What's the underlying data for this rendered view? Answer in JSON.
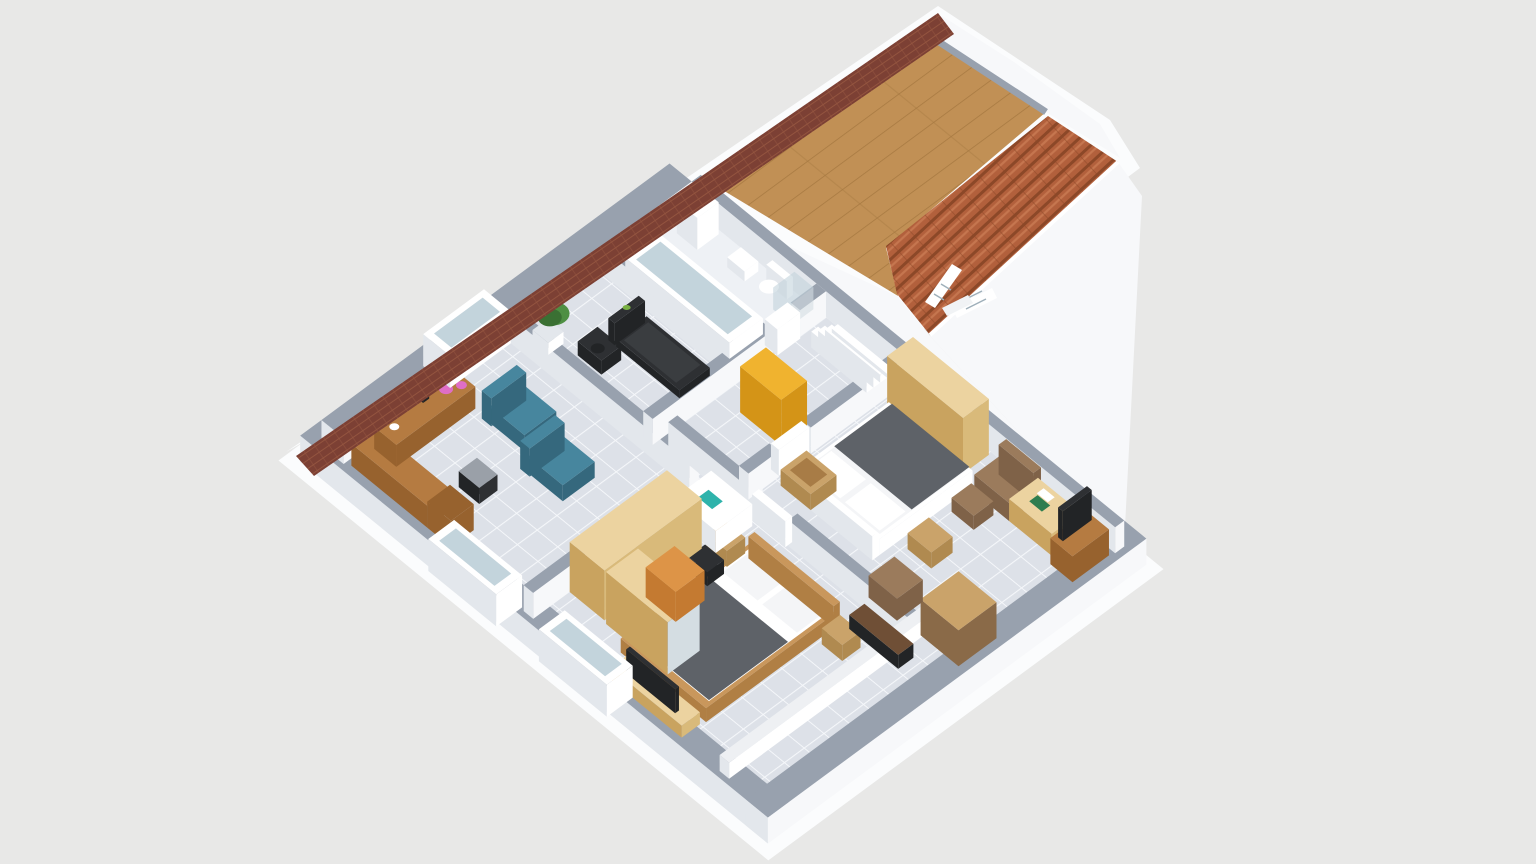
{
  "scene": {
    "type": "isometric-3d-floorplan-render",
    "view": "dollhouse cutaway of an attic storey, roof partially removed",
    "background": "plain light gray studio backdrop"
  },
  "colors": {
    "bg": "#e8e8e7",
    "slab": "#fbfcfd",
    "wallTop": "#98a1ae",
    "wallWhite": "#f7f8fa",
    "wallShade": "#e3e7ec",
    "floorBase": "#dde1e8",
    "floorLine": "#f5f7fa",
    "bathFloor": "#eef1f5",
    "corridorLow": "#eef0f3",
    "woodBase": "#c19055",
    "woodDark": "#a87a42",
    "roofTile": "#b2603c",
    "roofTileLight": "#c87a52",
    "roofTileDark": "#8c4828",
    "brickStrip": "#7c4034",
    "brickLine": "#93543f",
    "lightWood": "#ecd3a0",
    "lightWoodSide": "#d9ba7a",
    "lightWoodDark": "#c9a35f",
    "midWood": "#b57b41",
    "midWoodSide": "#97622e",
    "orange": "#dd9447",
    "orangeSide": "#c47a31",
    "yellow": "#f0b32f",
    "yellowSide": "#d49417",
    "teal": "#47869e",
    "tealSide": "#35687d",
    "blanket": "#5e6268",
    "pillow": "#f4f5f7",
    "white": "#ffffff",
    "bedFrame": "#c9975c",
    "bedFrameSide": "#b07f44",
    "brown": "#9b7b5c",
    "brownSide": "#7f6248",
    "benchBrown": "#6f4f36",
    "dark": "#2e3033",
    "darkSide": "#222426",
    "beltDark": "#3a3d40",
    "greenAccent": "#79b043",
    "green": "#4e8f43",
    "greenDark": "#3a7033",
    "pink": "#df6ec6",
    "metalGray": "#9aa0a8",
    "tan": "#caa36a",
    "tanSide": "#b08a50",
    "crateInner": "#a87c46",
    "shelfSide": "#8a6a48",
    "glass": "#c3d4dc",
    "mirror": "#d4dde2",
    "laptopTeal": "#2fb3ab",
    "bookGreen": "#2e7d4f",
    "paneLine": "#9fb0ba"
  },
  "rooms": [
    {
      "name": "Home office",
      "furniture": [
        "L-shaped wooden desk",
        "desk chair",
        "teal armchair",
        "teal armchair",
        "desk lamp",
        "pink flowers",
        "coffee cup",
        "window"
      ]
    },
    {
      "name": "Home gym",
      "furniture": [
        "treadmill",
        "exercise bike",
        "potted plant"
      ]
    },
    {
      "name": "Bathroom",
      "furniture": [
        "bathtub",
        "toilet",
        "bidet",
        "corner shower cabin",
        "bathroom cabinet"
      ]
    },
    {
      "name": "Hallway",
      "furniture": [
        "yellow dresser",
        "staircase",
        "white doors"
      ]
    },
    {
      "name": "Bedroom with dressing corner",
      "furniture": [
        "double bed with gray blanket",
        "long wardrobe",
        "sliding-door mirror wardrobe",
        "orange chest",
        "white desk with laptop",
        "office chair",
        "TV stand with TV",
        "nightstand",
        "nightstand",
        "dark bench",
        "two windows"
      ]
    },
    {
      "name": "Master bedroom",
      "furniture": [
        "double bed with gray blanket",
        "three-door wardrobe",
        "brown recliner armchair",
        "desk with green book",
        "TV cabinet with TV",
        "shelving unit",
        "nightstand",
        "wooden crate",
        "small chests"
      ]
    },
    {
      "name": "Side corridor",
      "furniture": [
        "low partition wall"
      ]
    },
    {
      "name": "Attic space",
      "furniture": [
        "plank wood floor",
        "terracotta roof slope",
        "open roof window",
        "white gable walls",
        "dark roof edge strip"
      ]
    }
  ]
}
